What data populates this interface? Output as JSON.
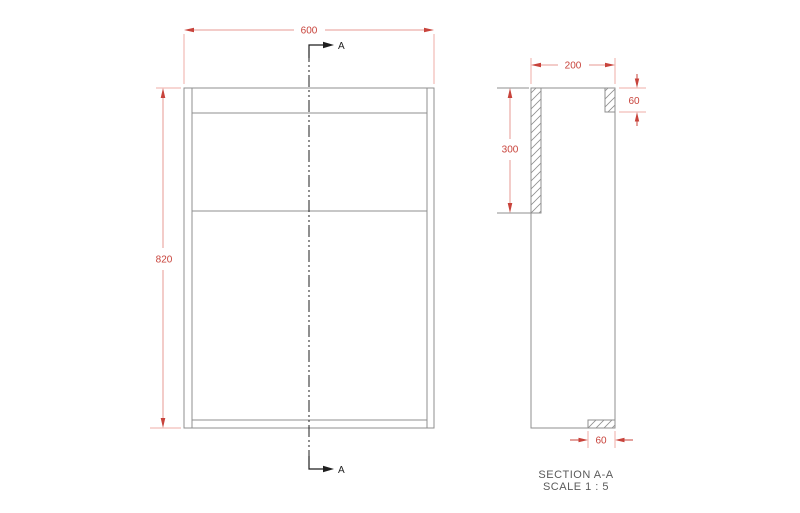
{
  "front_view": {
    "width_label": "600",
    "height_label": "820",
    "section_letter_top": "A",
    "section_letter_bottom": "A"
  },
  "section_view": {
    "depth_label": "200",
    "side_panel_label": "300",
    "top_rail_label": "60",
    "bottom_rail_label": "60",
    "caption_title": "SECTION A-A",
    "caption_scale": "SCALE 1 : 5"
  },
  "colors": {
    "dimension_red": "#c8433b",
    "extension_pink": "#efaca7",
    "outline_gray": "#8f8f8f",
    "section_line_black": "#1f1f1f",
    "caption_gray": "#5a5a5a",
    "background": "#ffffff"
  }
}
